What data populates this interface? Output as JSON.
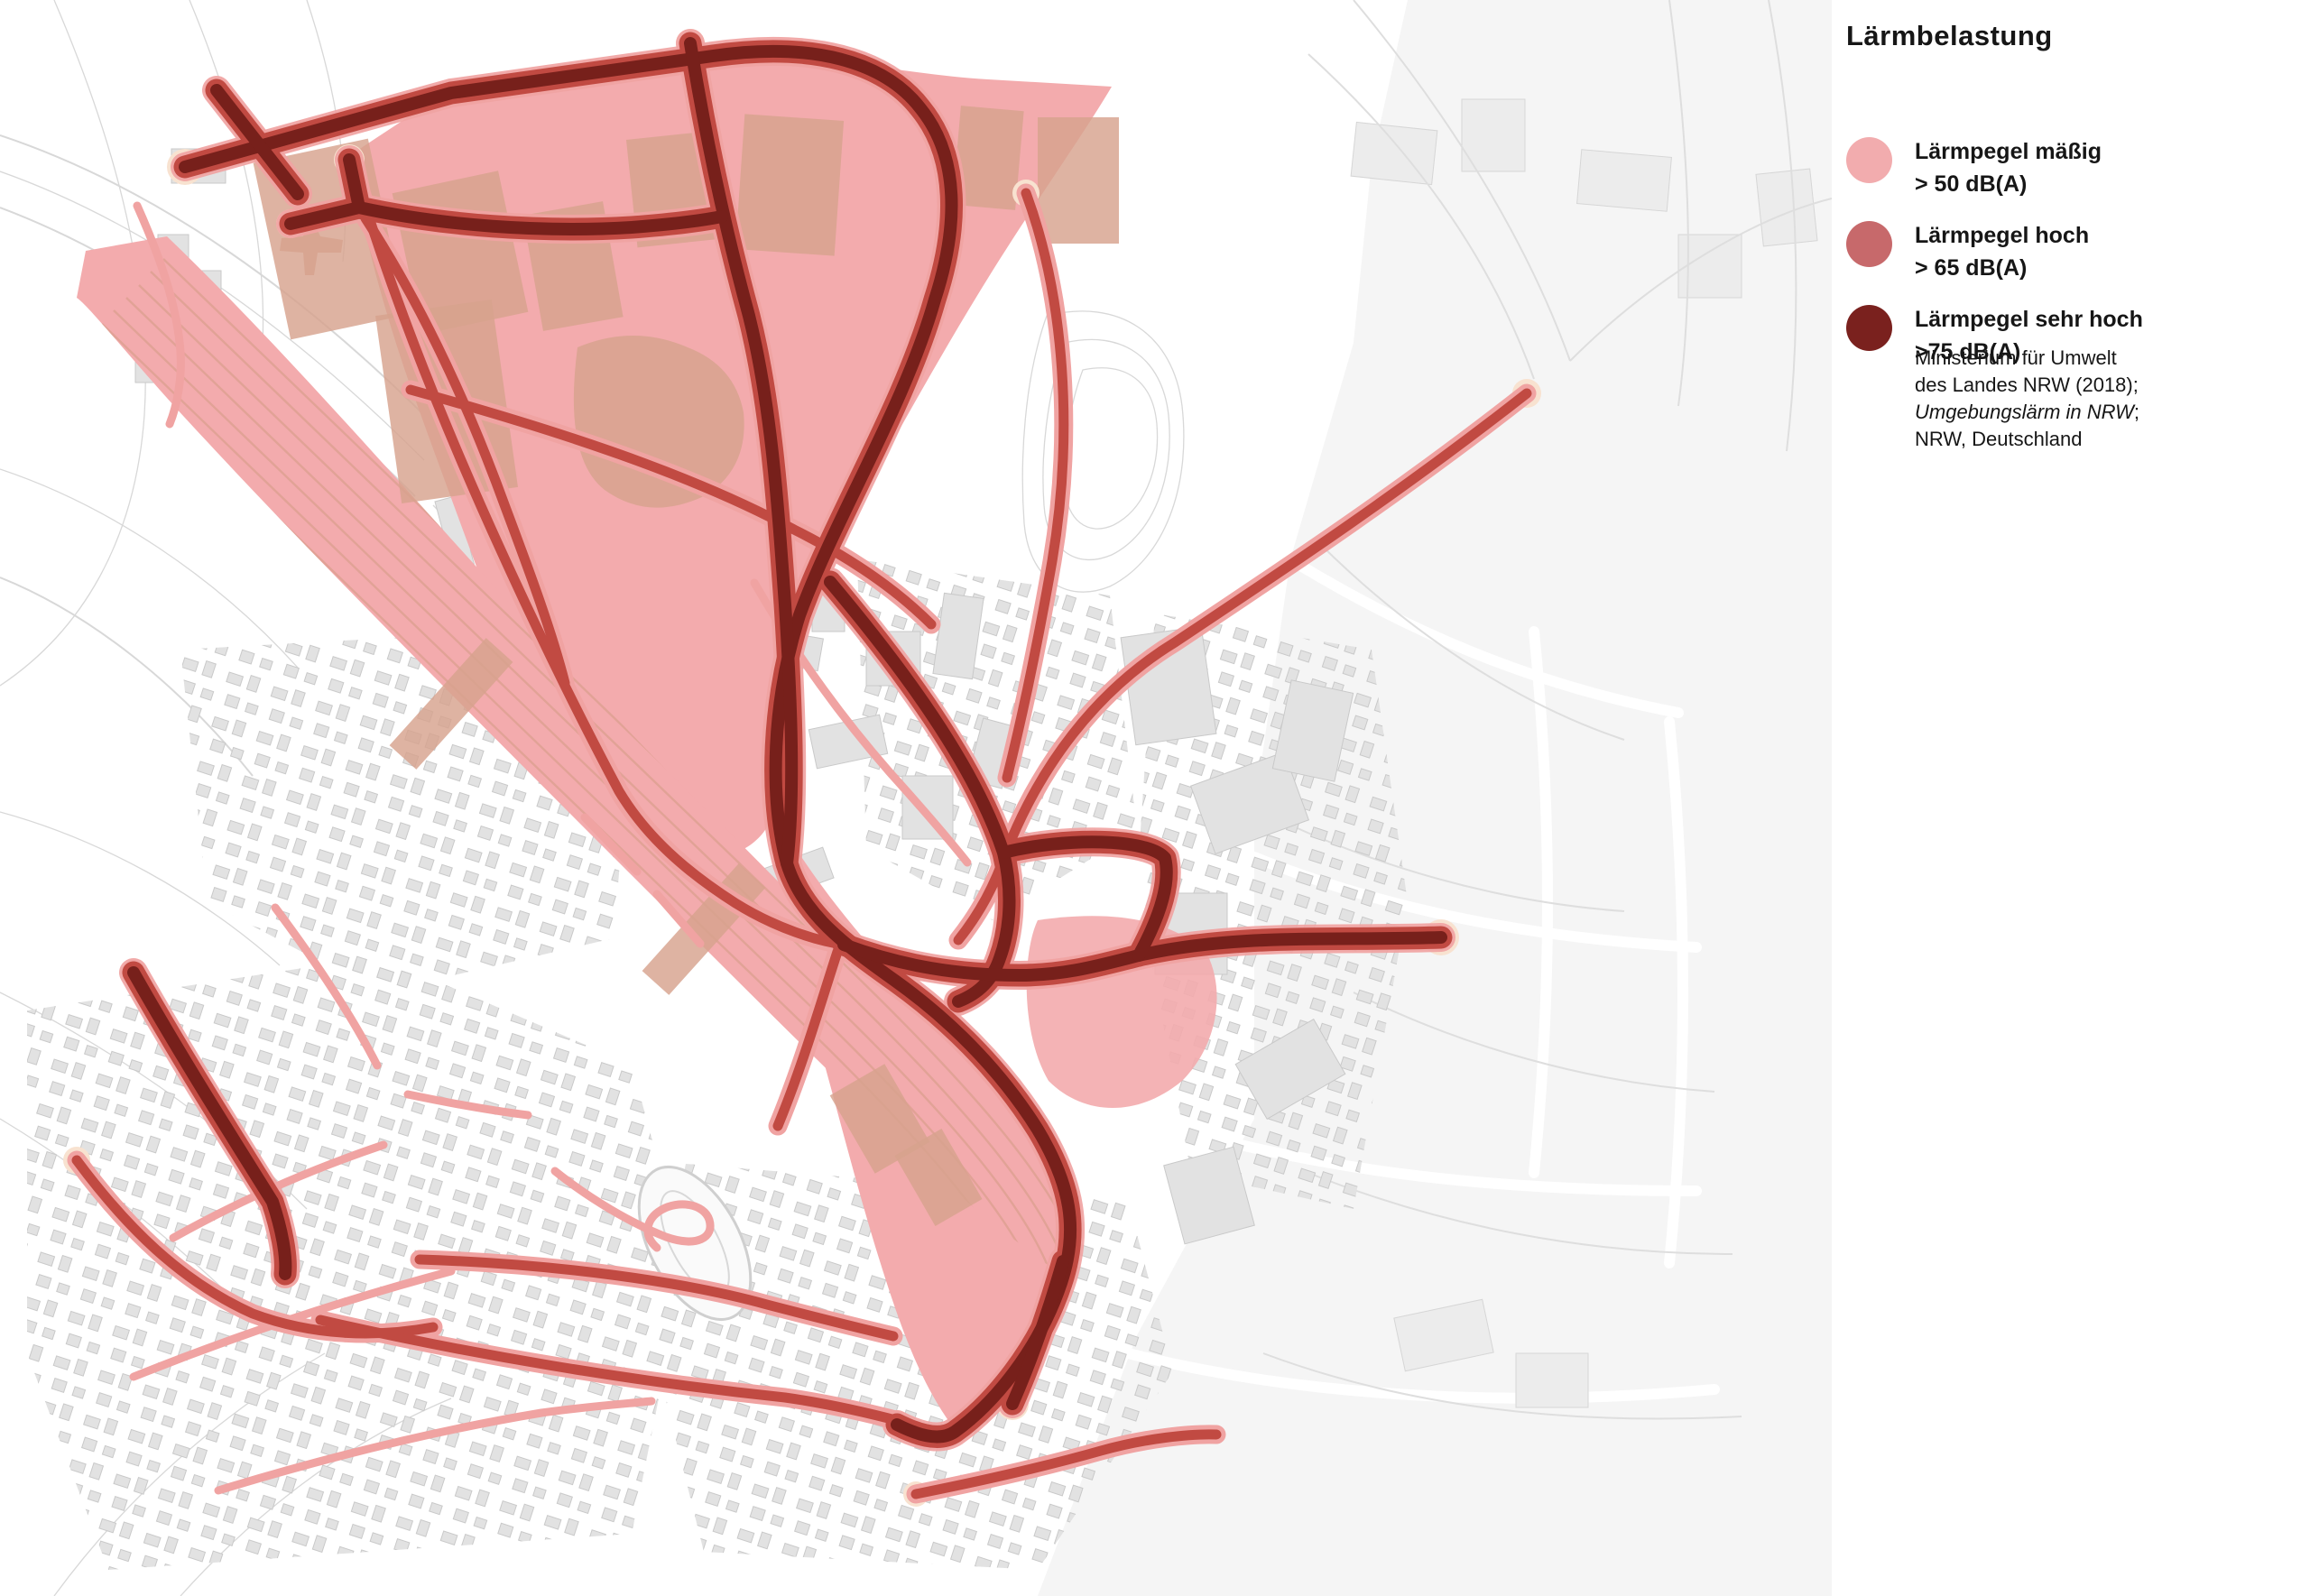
{
  "legend": {
    "title": "Lärmbelastung",
    "items": [
      {
        "label": "Lärmpegel mäßig",
        "threshold": "> 50 dB(A)",
        "color": "#F2ACAE"
      },
      {
        "label": "Lärmpegel hoch",
        "threshold": "> 65 dB(A)",
        "color": "#C7696B"
      },
      {
        "label": "Lärmpegel sehr hoch",
        "threshold": ">75 dB(A)",
        "color": "#7A211E"
      }
    ],
    "source": {
      "line1": "Ministerium für Umwelt",
      "line2": "des Landes NRW (2018);",
      "line3_italic": "Umgebungslärm in NRW",
      "line3_suffix": ";",
      "line4": "NRW, Deutschland"
    }
  },
  "map": {
    "type": "noise-pollution-map",
    "colors": {
      "noise_moderate": "#F3ABAD",
      "road_high": "#C14A42",
      "road_veryhigh": "#77201B",
      "minor_road": "#F0A3A2",
      "halo": "#F8E2D0",
      "tan_building": "#D7A28D",
      "rail_line": "#D19A83",
      "building": "#E2E2E2",
      "building_outline": "#C9C9C9",
      "building_light": "#ECECEC",
      "bg_right": "#F2F2F2",
      "faint_line": "#D8D8D8"
    }
  }
}
